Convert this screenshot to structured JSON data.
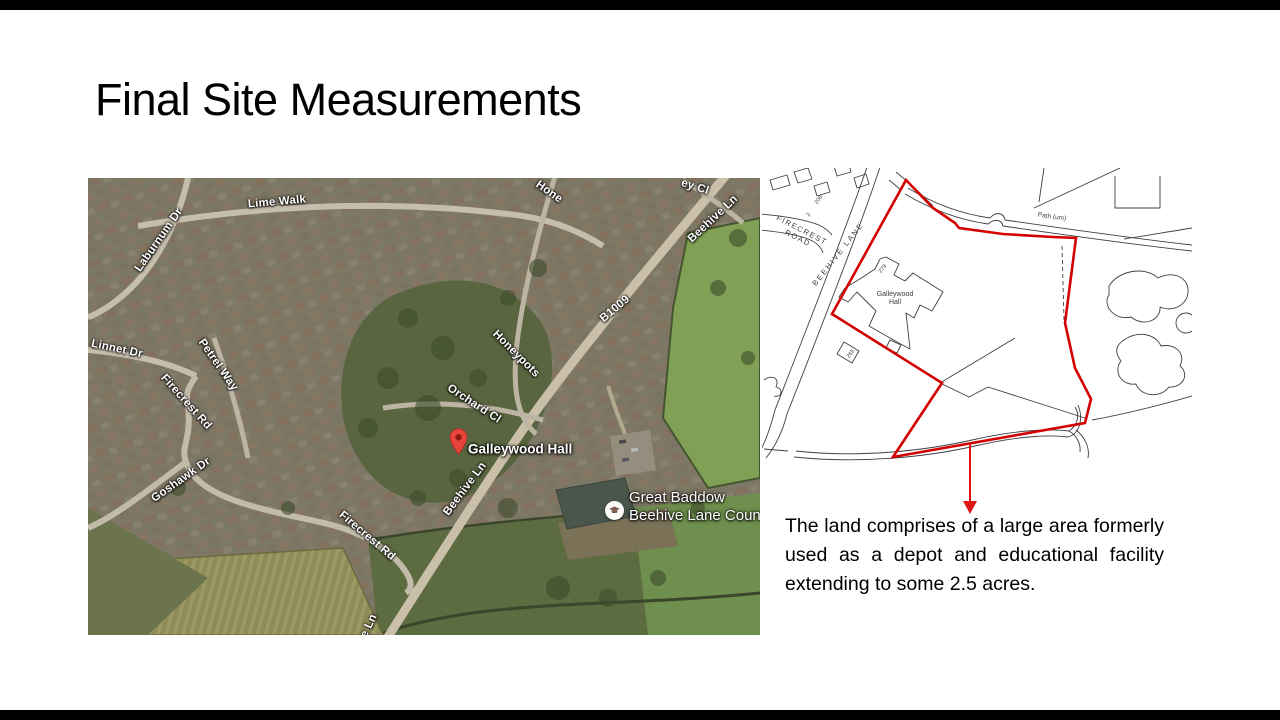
{
  "slide": {
    "title": "Final Site Measurements",
    "letterbox_color": "#000000",
    "background": "#ffffff"
  },
  "caption": {
    "text": "The land comprises of a large area formerly used as a depot and educational facility extending to some 2.5 acres."
  },
  "map": {
    "kind": "aerial-satellite-view",
    "street_labels": [
      {
        "text": "Lime Walk"
      },
      {
        "text": "Laburnum Dr"
      },
      {
        "text": "Linnet Dr"
      },
      {
        "text": "Petrel Way"
      },
      {
        "text": "Firecrest Rd"
      },
      {
        "text": "Goshawk Dr"
      },
      {
        "text": "Firecrest Rd"
      },
      {
        "text": "Hone"
      },
      {
        "text": "ey Cl"
      },
      {
        "text": "Beehive Ln"
      },
      {
        "text": "B1009"
      },
      {
        "text": "Honeypots"
      },
      {
        "text": "Orchard Cl"
      },
      {
        "text": "Beehive Ln"
      },
      {
        "text": "e Ln"
      }
    ],
    "pin_label": "Galleywood Hall",
    "school_label_line1": "Great Baddow",
    "school_label_line2": "Beehive Lane County…",
    "pin_color": "#e7453c"
  },
  "site_plan": {
    "road_label_1a": "FIRECREST",
    "road_label_1b": "ROAD",
    "road_label_2": "BEEHIVE LANE",
    "path_label": "Path (um)",
    "building_label_1": "Galleywood",
    "building_label_2": "Hall",
    "number_279": "279",
    "number_208": "208",
    "number_2": "2",
    "number_265": "265",
    "boundary_color": "#d40000",
    "arrow_color": "#e01414"
  }
}
